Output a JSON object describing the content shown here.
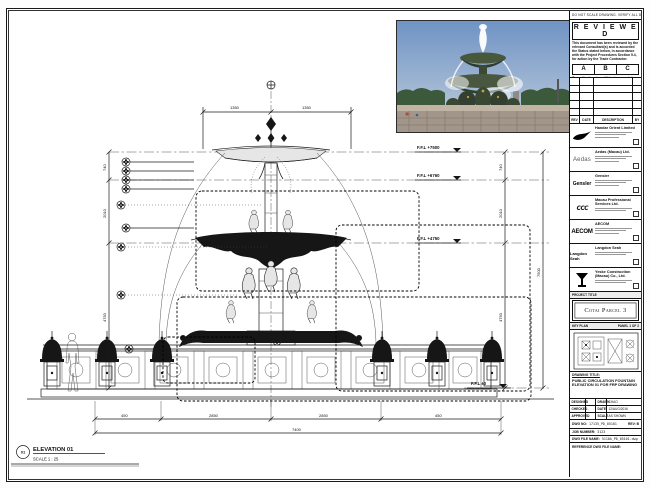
{
  "sheet": {
    "note_strip": "DO NOT SCALE DRAWING. VERIFY ALL DIMENSIONS ON SITE."
  },
  "stamp": {
    "title": "R E V I E W E D",
    "para1": "This document has been reviewed by the relevant Consultant(s) and is accorded the Status stated below, in accordance with the Project Procedures Section 5.4, for action by the Trade Contractor.",
    "options": [
      "A",
      "B",
      "C"
    ],
    "para2": "Consultant review of this document does not relieve the Trade Contractor of its responsibilities under the Trade Contract.",
    "date_label": "Date :"
  },
  "revision_table": {
    "headers": [
      "REV",
      "DATE",
      "DESCRIPTION",
      "BY"
    ]
  },
  "consultants": [
    {
      "name": "Handar Orient Limited"
    },
    {
      "name": "Aedas (Macau) Ltd.",
      "logo_text": "Aedas"
    },
    {
      "name": "Gensler",
      "logo_text": "Gensler"
    },
    {
      "name": "Macau Professional Services Ltd.",
      "logo_text": "ccc"
    },
    {
      "name": "AECOM",
      "logo_text": "AECOM"
    },
    {
      "name": "Langdon Seah",
      "logo_text": "Langdon Seah"
    },
    {
      "name": "Yeske Construction (Macau) Co., Ltd."
    }
  ],
  "project": {
    "title_label": "PROJECT TITLE",
    "name": "Cotai Parcel 3"
  },
  "key_plan": {
    "label": "KEY PLAN",
    "panel": "PANEL 1 OF 2"
  },
  "title_block": {
    "drawing_title_label": "DRAWING TITLE:",
    "drawing_title": "PUBLIC CIRCULATION FOUNTAIN ELEVATION 01 FOR FRP DRAWING",
    "designed_label": "DESIGNED",
    "designed": "",
    "drawn_label": "DRAWN",
    "drawn": "CHAO",
    "checked_label": "CHECKED",
    "checked": "-",
    "date_label": "DATE",
    "date": "12/AUG/2016",
    "approved_label": "APPROVED",
    "approved": "-",
    "scale_label": "SCALE",
    "scale": "AS SHOWN",
    "dwg_no_label": "DWG NO:",
    "dwg_no": "17135_PD_05101",
    "rev_label": "REV:",
    "rev": "B",
    "job_label": "JOB NUMBER:",
    "job": "3123",
    "file_label": "DWG FILE NAME:",
    "file": "5110A_PD_05101.dwg",
    "ref_label": "REFERENCE DWG FILE NAME:"
  },
  "drawing": {
    "elevation_no": "01",
    "elevation_label": "ELEVATION 01",
    "scale_note": "SCALE  1 : 25",
    "levels": [
      "F.F.L +7500",
      "F.F.L +6760",
      "F.F.L +4750",
      "F.F.L ±0"
    ],
    "dims": {
      "top_left": "1350",
      "top_right": "1350",
      "right_seg1": "740",
      "right_seg2": "2010",
      "right_seg3": "4750",
      "right_total": "7500",
      "left_seg1": "740",
      "left_seg2": "2010",
      "left_seg3": "4750",
      "bottom_seg1": "450",
      "bottom_seg2": "2850",
      "bottom_seg3": "2850",
      "bottom_seg4": "450",
      "bottom_total": "7400"
    }
  }
}
